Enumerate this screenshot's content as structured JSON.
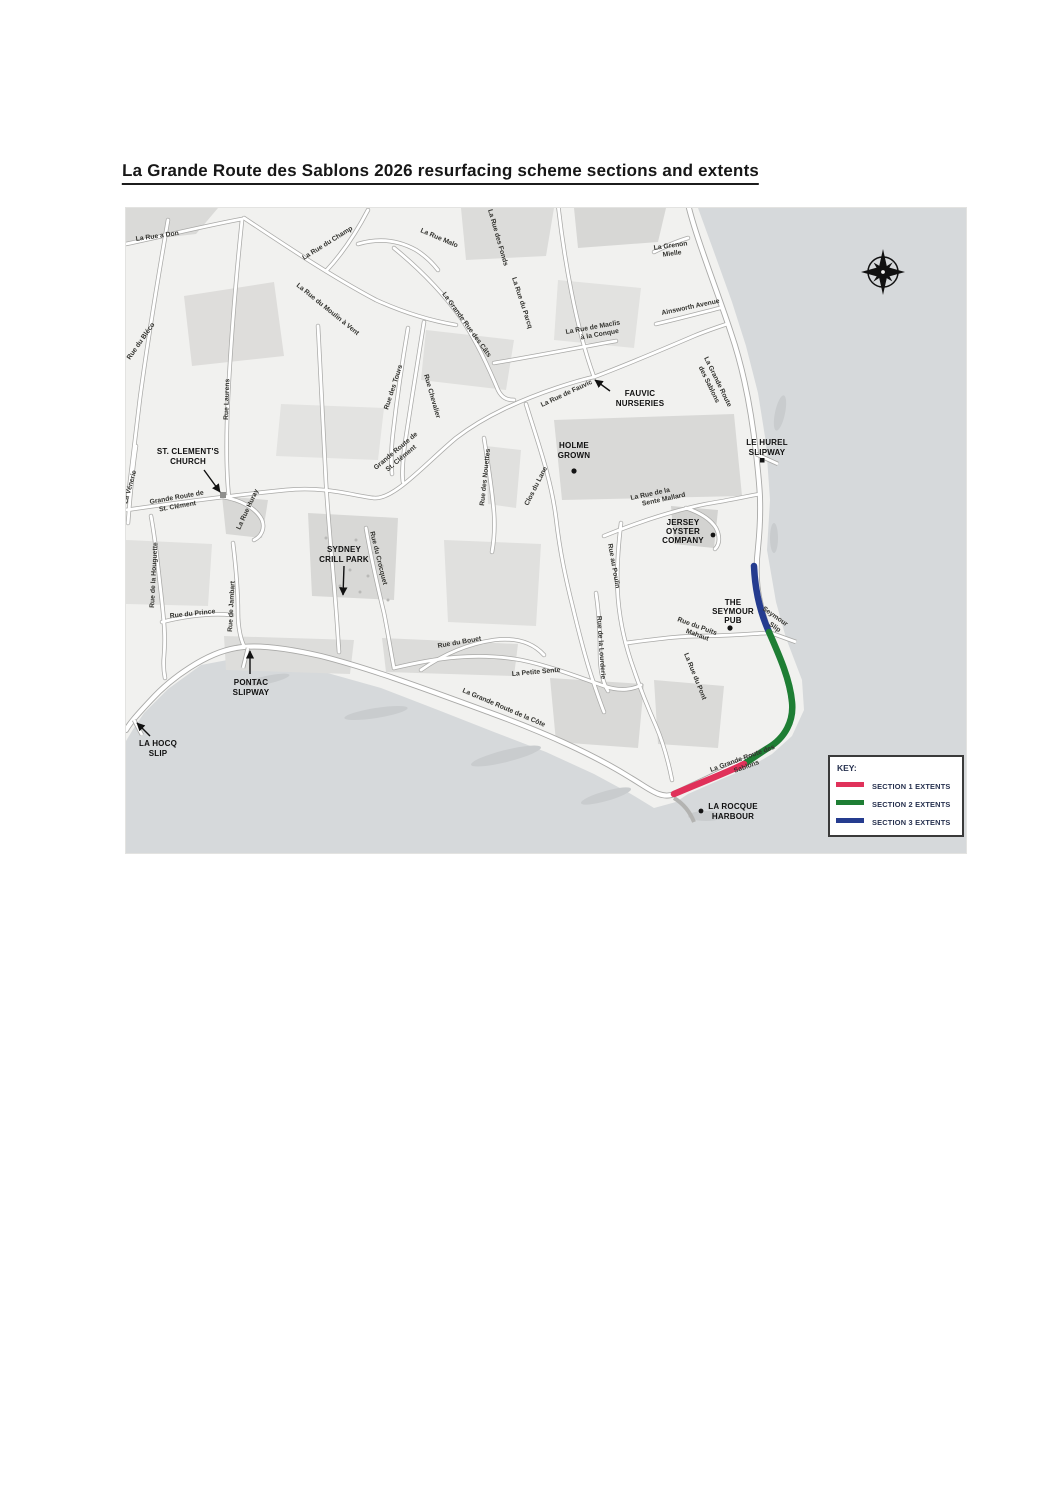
{
  "page": {
    "title": "La Grande Route des Sablons 2026 resurfacing scheme sections and extents"
  },
  "map": {
    "colors": {
      "land": "#f1f1ef",
      "sea": "#d6d9db"
    },
    "key": {
      "title": "KEY:",
      "items": [
        {
          "label": "SECTION 1 EXTENTS",
          "color": "#e0315a"
        },
        {
          "label": "SECTION 2 EXTENTS",
          "color": "#1e7e34"
        },
        {
          "label": "SECTION 3 EXTENTS",
          "color": "#253c8f"
        }
      ]
    },
    "labels": {
      "st_clements_church": [
        "ST. CLEMENT'S",
        "CHURCH"
      ],
      "sydney_crill_park": [
        "SYDNEY",
        "CRILL PARK"
      ],
      "pontac_slipway": [
        "PONTAC",
        "SLIPWAY"
      ],
      "la_hocq_slip": [
        "LA HOCQ",
        "SLIP"
      ],
      "fauvic_nurseries": [
        "FAUVIC",
        "NURSERIES"
      ],
      "holme_grown": [
        "HOLME",
        "GROWN"
      ],
      "le_hurel_slipway": [
        "LE HUREL",
        "SLIPWAY"
      ],
      "jersey_oyster_company": [
        "JERSEY",
        "OYSTER",
        "COMPANY"
      ],
      "the_seymour_pub": [
        "THE",
        "SEYMOUR",
        "PUB"
      ],
      "la_rocque_harbour": [
        "LA ROCQUE",
        "HARBOUR"
      ],
      "seymour_slip": [
        "Seymour",
        "Slip"
      ],
      "rue_a_don": "La Rue a Don",
      "rue_du_champ": "La Rue du Champ",
      "moulin_a_vent": "La Rue du Moulin à Vent",
      "rue_du_bleco": "Rue du Bléco",
      "rue_laurens": "Rue Laurens",
      "rue_malo": "La Rue Malo",
      "rue_des_fonds": "La Rue des Fonds",
      "rue_du_parcq": "La Rue du Parcq",
      "grande_rue_des_cats": "La Grande Rue des Câts",
      "maclis": [
        "La Rue de Maclis",
        "à la Conque"
      ],
      "rue_de_fauvic": "La Rue de Fauvic",
      "grst_clement_1": [
        "Grande Route de",
        "St. Clément"
      ],
      "grst_clement_2": [
        "Grande Route de",
        "St. Clément"
      ],
      "rue_des_tours": "Rue des Tours",
      "rue_chevalier": "Rue Chevalier",
      "rue_des_nouettes": "Rue des Nouettes",
      "clos_du_lane": "Clos du Lane",
      "la_venerie": "La Vénerie",
      "rue_huray": "La Rue Huray",
      "houguette": "Rue de la Houguette",
      "jambart": "Rue de Jambart",
      "rue_du_prince": "Rue du Prince",
      "crocquet": "Rue du Crocquet",
      "rue_du_bouet": "Rue du Bouet",
      "petite_sente": "La Petite Sente",
      "grande_route_cote": "La Grande Route de la Côte",
      "lourderie": "Rue de la Lourderie",
      "sente_mallard": [
        "La Rue de la",
        "Sente Mallard"
      ],
      "rue_au_poulin": "Rue au Poulin",
      "rue_du_pont": "La Rue du Pont",
      "puits_mahaut": [
        "Rue du Puits",
        "Mahaut"
      ],
      "sablons_top": [
        "La Grande Route",
        "des Sablons"
      ],
      "sablons_bottom": [
        "La Grande Route des",
        "Sablons"
      ],
      "grenon_mielle": [
        "La Grenon",
        "Mielle"
      ],
      "ainsworth": "Ainsworth Avenue"
    }
  }
}
